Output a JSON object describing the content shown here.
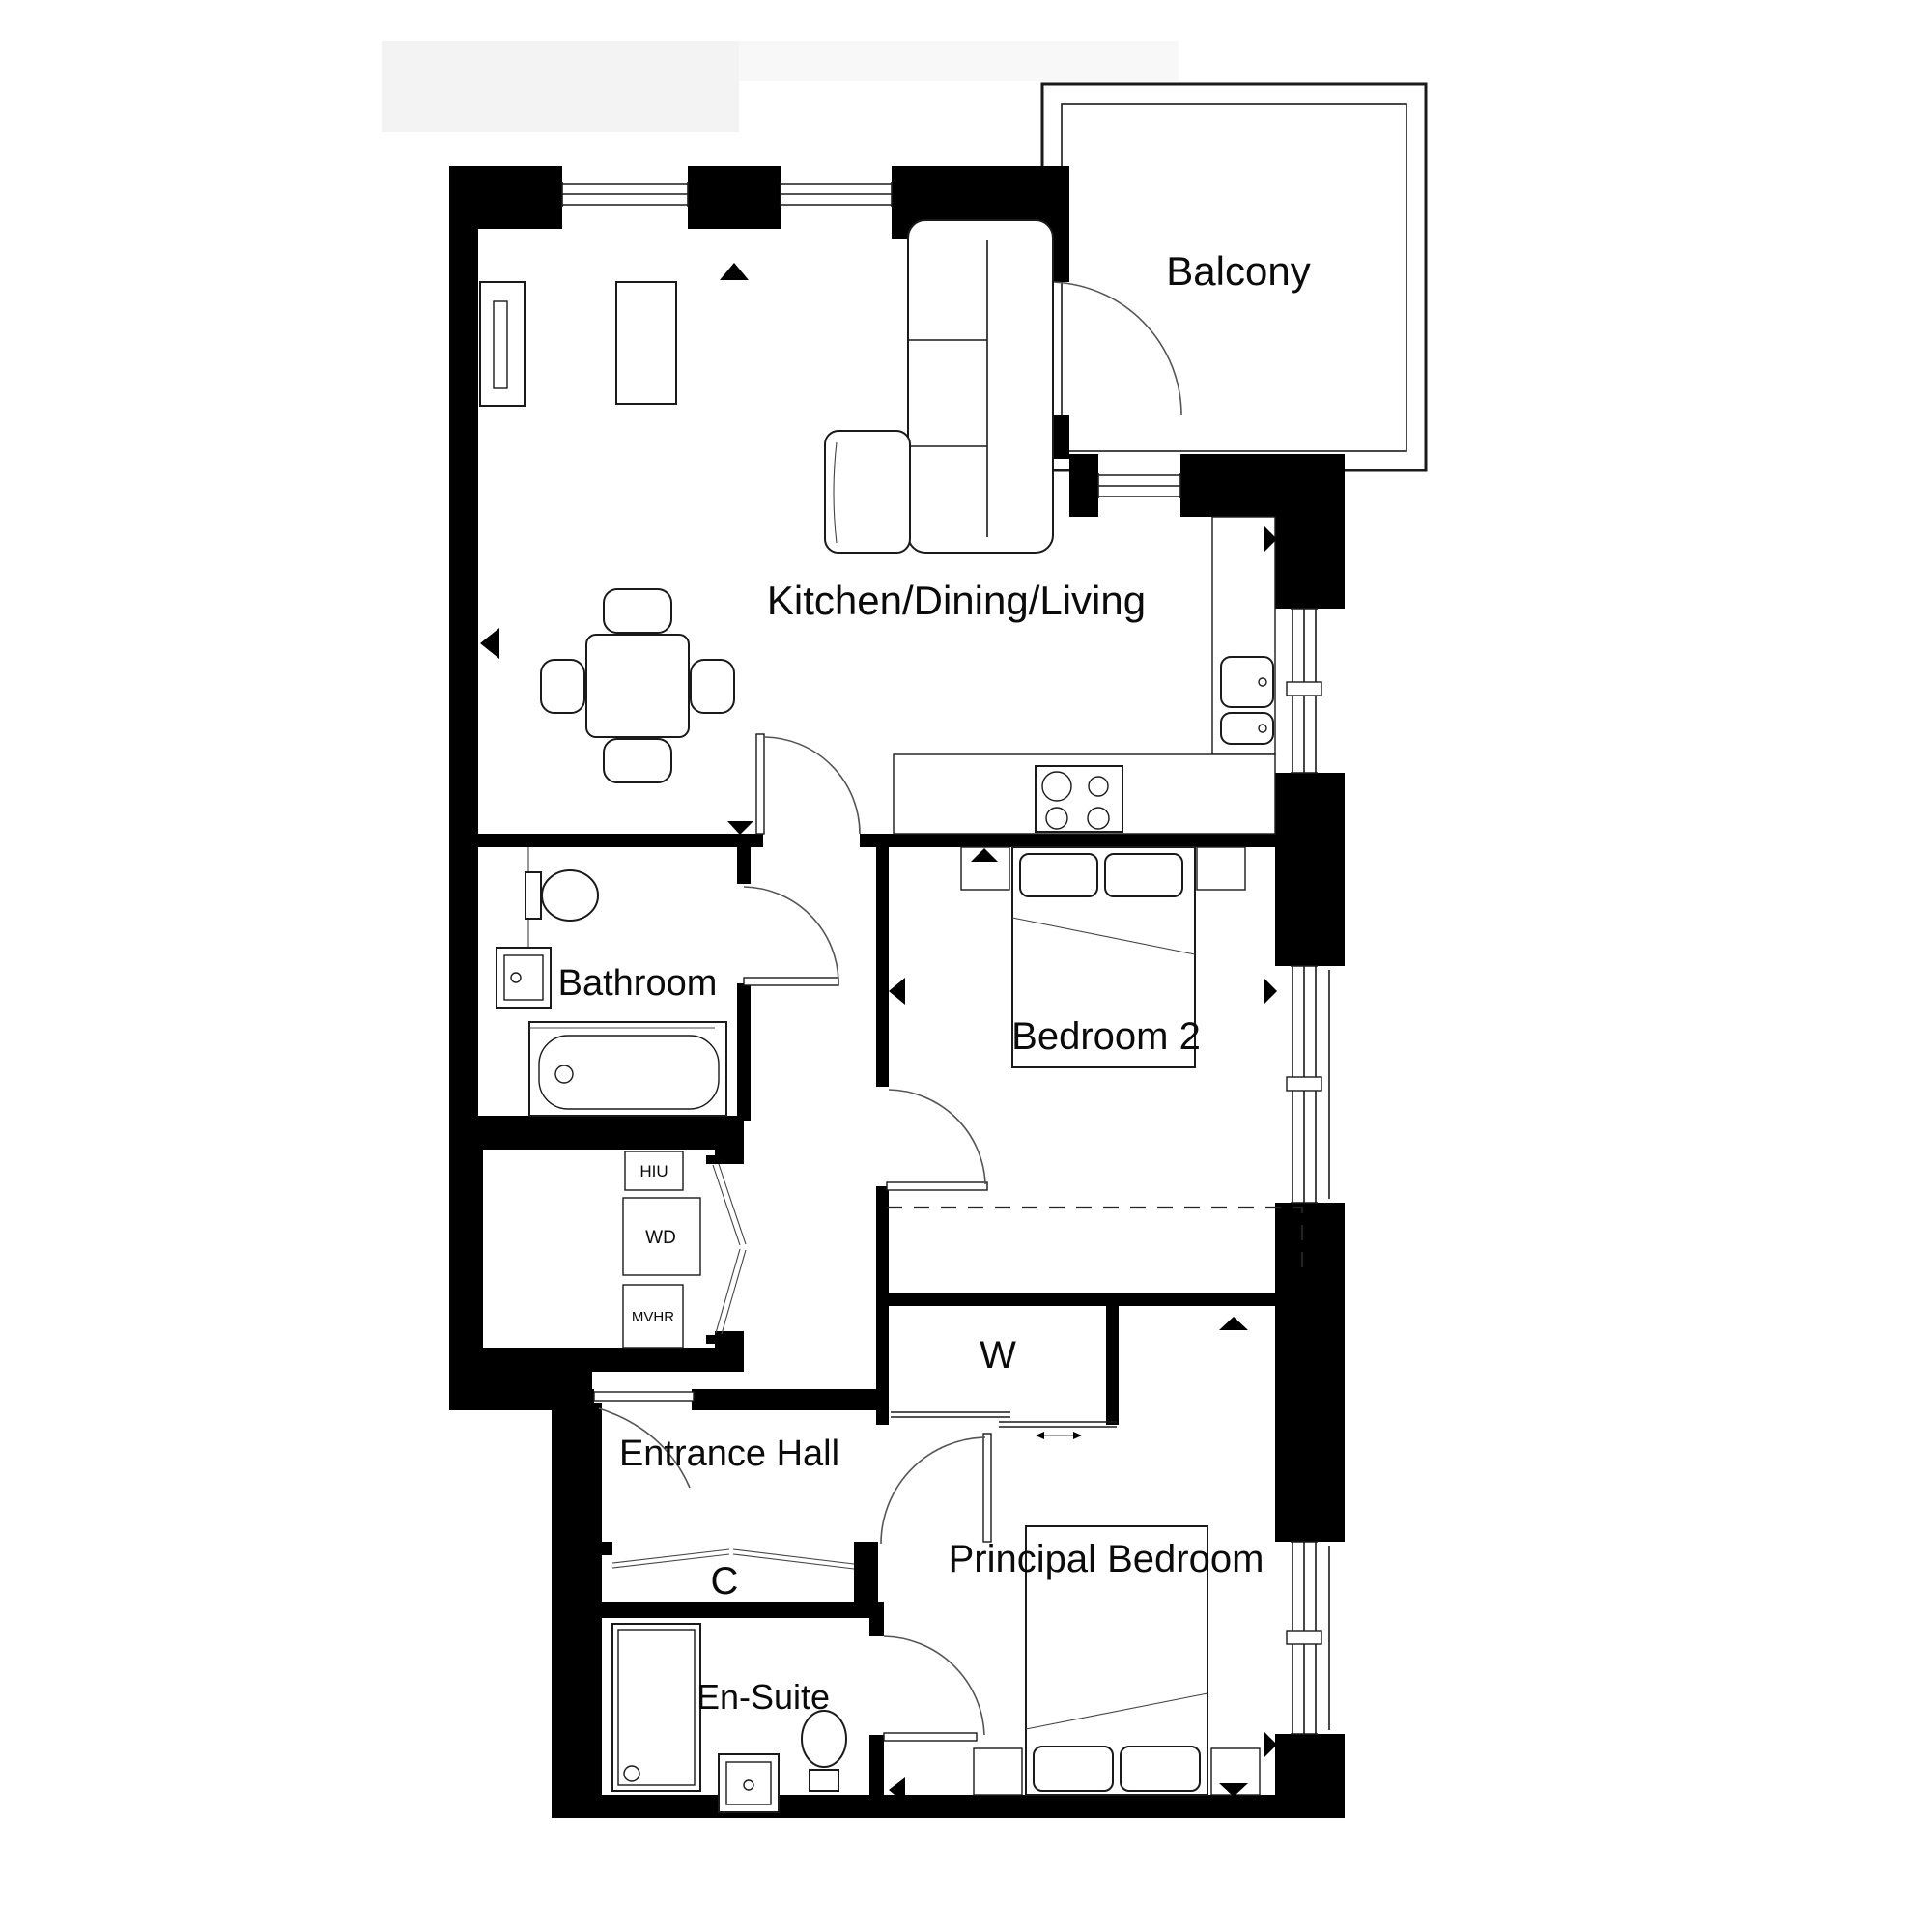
{
  "plan": {
    "type": "apartment-floor-plan",
    "rooms": [
      {
        "id": "balcony",
        "label": "Balcony"
      },
      {
        "id": "kitchen-dining-living",
        "label": "Kitchen/Dining/Living"
      },
      {
        "id": "bathroom",
        "label": "Bathroom"
      },
      {
        "id": "bedroom-2",
        "label": "Bedroom 2"
      },
      {
        "id": "entrance-hall",
        "label": "Entrance Hall"
      },
      {
        "id": "wardrobe",
        "label": "W"
      },
      {
        "id": "cupboard",
        "label": "C"
      },
      {
        "id": "en-suite",
        "label": "En-Suite"
      },
      {
        "id": "principal-bedroom",
        "label": "Principal Bedroom"
      }
    ],
    "utilities": [
      {
        "id": "hiu",
        "label": "HIU"
      },
      {
        "id": "wd",
        "label": "WD"
      },
      {
        "id": "mvhr",
        "label": "MVHR"
      }
    ],
    "colors": {
      "wall": "#000000",
      "background": "#ffffff",
      "linework": "#1a1a1a"
    }
  }
}
